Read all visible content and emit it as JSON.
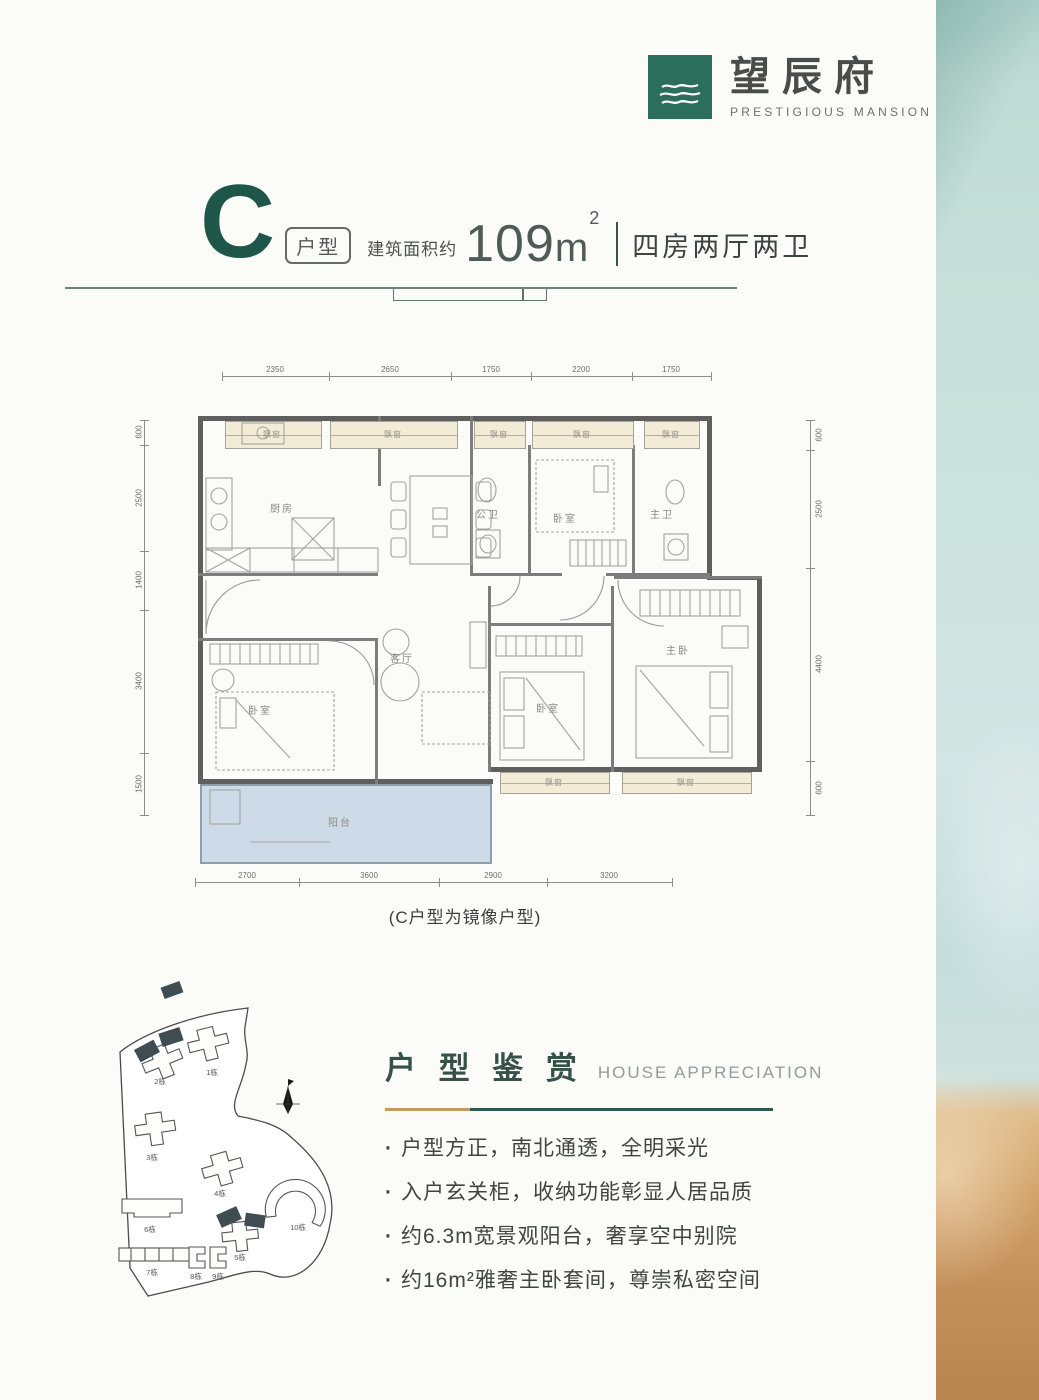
{
  "logo": {
    "cn": "望辰府",
    "en": "PRESTIGIOUS MANSION",
    "icon": "waves-icon",
    "brand_color": "#2c6e5c"
  },
  "title": {
    "letter": "C",
    "tag": "户型",
    "area_label": "建筑面积约",
    "area_number": "109",
    "area_unit": "m",
    "area_exp": "2",
    "rooms": "四房两厅两卫"
  },
  "floorplan": {
    "caption": "(C户型为镜像户型)",
    "labels": {
      "kitchen": "厨房",
      "living": "客厅",
      "balcony": "阳台",
      "bedroom": "卧室",
      "master_bedroom": "主卧",
      "public_bath": "公卫",
      "master_bath": "主卫",
      "bay_window": "飘窗"
    },
    "dims_top": [
      "2350",
      "2650",
      "1750",
      "2200",
      "1750"
    ],
    "dims_bottom": [
      "2700",
      "3600",
      "2900",
      "3200"
    ],
    "dims_left": [
      "600",
      "2500",
      "1400",
      "3400",
      "1500"
    ],
    "dims_right": [
      "600",
      "2500",
      "4400",
      "600"
    ]
  },
  "sitemap": {
    "buildings": [
      "1栋",
      "2栋",
      "3栋",
      "4栋",
      "5栋",
      "6栋",
      "7栋",
      "8栋",
      "9栋",
      "10栋"
    ],
    "compass": "north-compass-icon",
    "highlight_color": "#3f4c52"
  },
  "appreciation": {
    "title_cn": "户 型 鉴 赏",
    "title_en": "HOUSE APPRECIATION",
    "bullets": [
      "户型方正，南北通透，全明采光",
      "入户玄关柜，收纳功能彰显人居品质",
      "约6.3m宽景观阳台，奢享空中别院",
      "约16m²雅奢主卧套间，尊崇私密空间"
    ]
  },
  "colors": {
    "brand_green": "#2c6e5c",
    "title_green": "#1e574a",
    "accent_teal": "#2b5a51",
    "accent_gold": "#c2995f",
    "bay_beige": "#f2ecd7",
    "balcony_blue": "#ccdbe7",
    "band_teal": "#c8e0db",
    "band_sand": "#c3905a"
  }
}
